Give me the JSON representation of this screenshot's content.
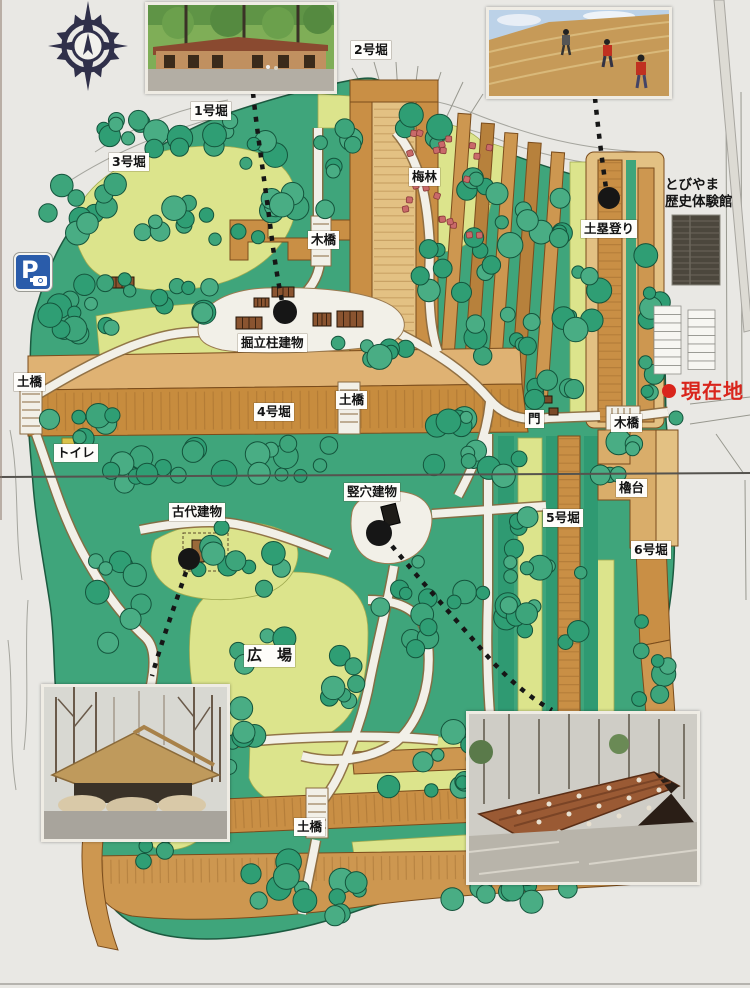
{
  "sign": {
    "current_location": "現在地",
    "facility_name_line1": "とびやま",
    "facility_name_line2": "歴史体験館",
    "parking_sign": "P"
  },
  "labels": {
    "moat1": "1号堀",
    "moat2": "2号堀",
    "moat3": "3号堀",
    "moat4": "4号堀",
    "moat5": "5号堀",
    "moat6": "6号堀",
    "plum_grove": "梅林",
    "wooden_bridge_north": "木橋",
    "wooden_bridge_east": "木橋",
    "pillar_buildings": "掘立柱建物",
    "earth_bridge_west": "土橋",
    "earth_bridge_center": "土橋",
    "earth_bridge_south": "土橋",
    "toilet": "トイレ",
    "gate": "門",
    "ancient_building": "古代建物",
    "pit_building": "竪穴建物",
    "plaza": "広　場",
    "turret_platform": "櫓台",
    "earthwork_climbing": "土塁登り"
  },
  "icons": {
    "compass_rose": "eight-point-star",
    "parking_camera": "camera-glyph",
    "current_location_dot": "red-dot",
    "viewpoint_dot": "black-dot"
  },
  "colors": {
    "current_location_red": "#d9251c",
    "parking_blue": "#2a5caa",
    "tree_green": "#3da57b",
    "field_yellow": "#dce48c",
    "moat_brown": "#c98f45"
  }
}
